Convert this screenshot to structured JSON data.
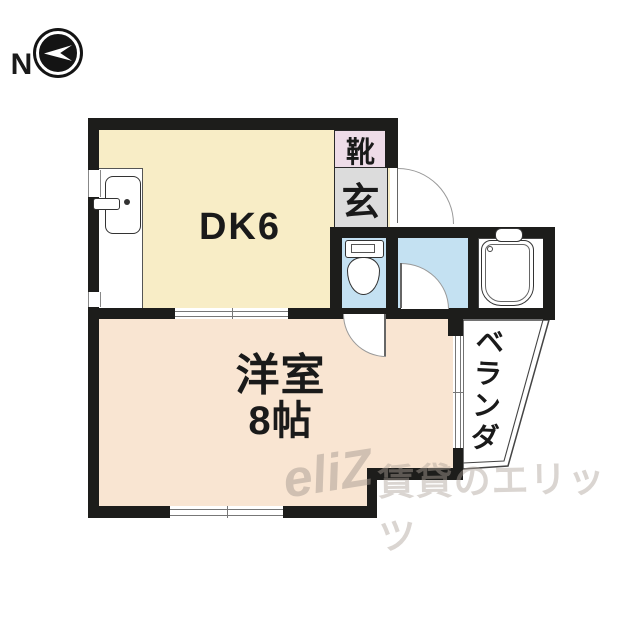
{
  "compass": {
    "letter": "N"
  },
  "plan": {
    "rooms": {
      "dk": {
        "label": "DK6"
      },
      "bedroom": {
        "label_line1": "洋室",
        "label_line2": "8帖"
      },
      "shoes": {
        "label": "靴"
      },
      "entrance": {
        "label": "玄"
      },
      "veranda": {
        "label": "ベランダ"
      }
    },
    "fixtures": {
      "toilet": "toilet-icon",
      "bathtub": "bathtub-icon",
      "kitchen_sink": "kitchen-sink-icon"
    },
    "colors": {
      "wall": "#1d1d1b",
      "dk_floor": "#f8edc6",
      "bedroom_floor": "#f9e5d2",
      "wet_area_floor": "#c4e1f2",
      "shoes_box": "#eedce8",
      "entrance_floor": "#dcdcdc",
      "watermark": "#a89c90"
    }
  },
  "watermark": {
    "logo": "eliZ",
    "text": "賃貸のエリッツ"
  }
}
